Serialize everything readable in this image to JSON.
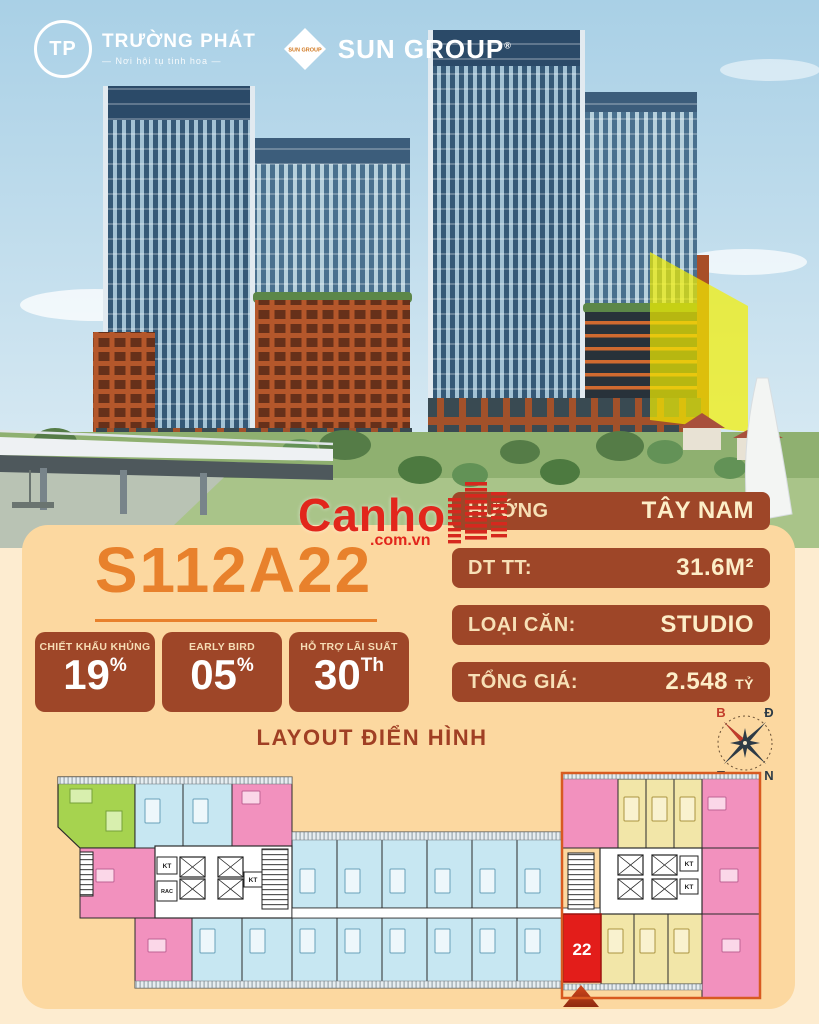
{
  "header": {
    "truong_phat": {
      "monogram": "TP",
      "name": "TRƯỜNG PHÁT",
      "tagline": "— Nơi hội tụ tinh hoa —"
    },
    "sun_group": {
      "diamond_text": "SUN GROUP",
      "name": "SUN GROUP",
      "reg": "®"
    }
  },
  "watermark": {
    "brand": "Canho",
    "domain": ".com.vn"
  },
  "unit": {
    "code": "S112A22"
  },
  "badges": [
    {
      "label": "CHIẾT KHẤU KHỦNG",
      "value": "19",
      "unit": "%"
    },
    {
      "label": "EARLY BIRD",
      "value": "05",
      "unit": "%"
    },
    {
      "label": "HỖ TRỢ LÃI SUẤT",
      "value": "30",
      "unit": "Th"
    }
  ],
  "specs": {
    "direction": {
      "label": "HƯỚNG",
      "value": "TÂY NAM"
    },
    "area": {
      "label": "DT TT:",
      "value": "31.6M²"
    },
    "type": {
      "label": "LOẠI CĂN:",
      "value": "STUDIO"
    },
    "price": {
      "label": "TỔNG GIÁ:",
      "value": "2.548",
      "unit": "TỶ"
    }
  },
  "floorplan": {
    "title": "LAYOUT ĐIỂN HÌNH",
    "unit_marker": "22",
    "labels": {
      "kt": "KT",
      "rac": "RAC"
    },
    "compass": {
      "top_left": "B",
      "top_right": "Đ",
      "bottom_left": "T",
      "bottom_right": "N"
    }
  },
  "colors": {
    "accent_orange": "#e8812c",
    "card_bg": "#fcd8a0",
    "panel_dark": "#9e4628",
    "cream_text": "#f7e0b6",
    "value_text": "#fdeec8",
    "title_red": "#a03f24",
    "watermark_red": "#e2261c",
    "highlight_unit": "#e31d1a",
    "plan_blue": "#c7e7f2",
    "plan_pink": "#f291be",
    "plan_yellow": "#f2e6a8",
    "plan_green": "#a6d34f"
  }
}
